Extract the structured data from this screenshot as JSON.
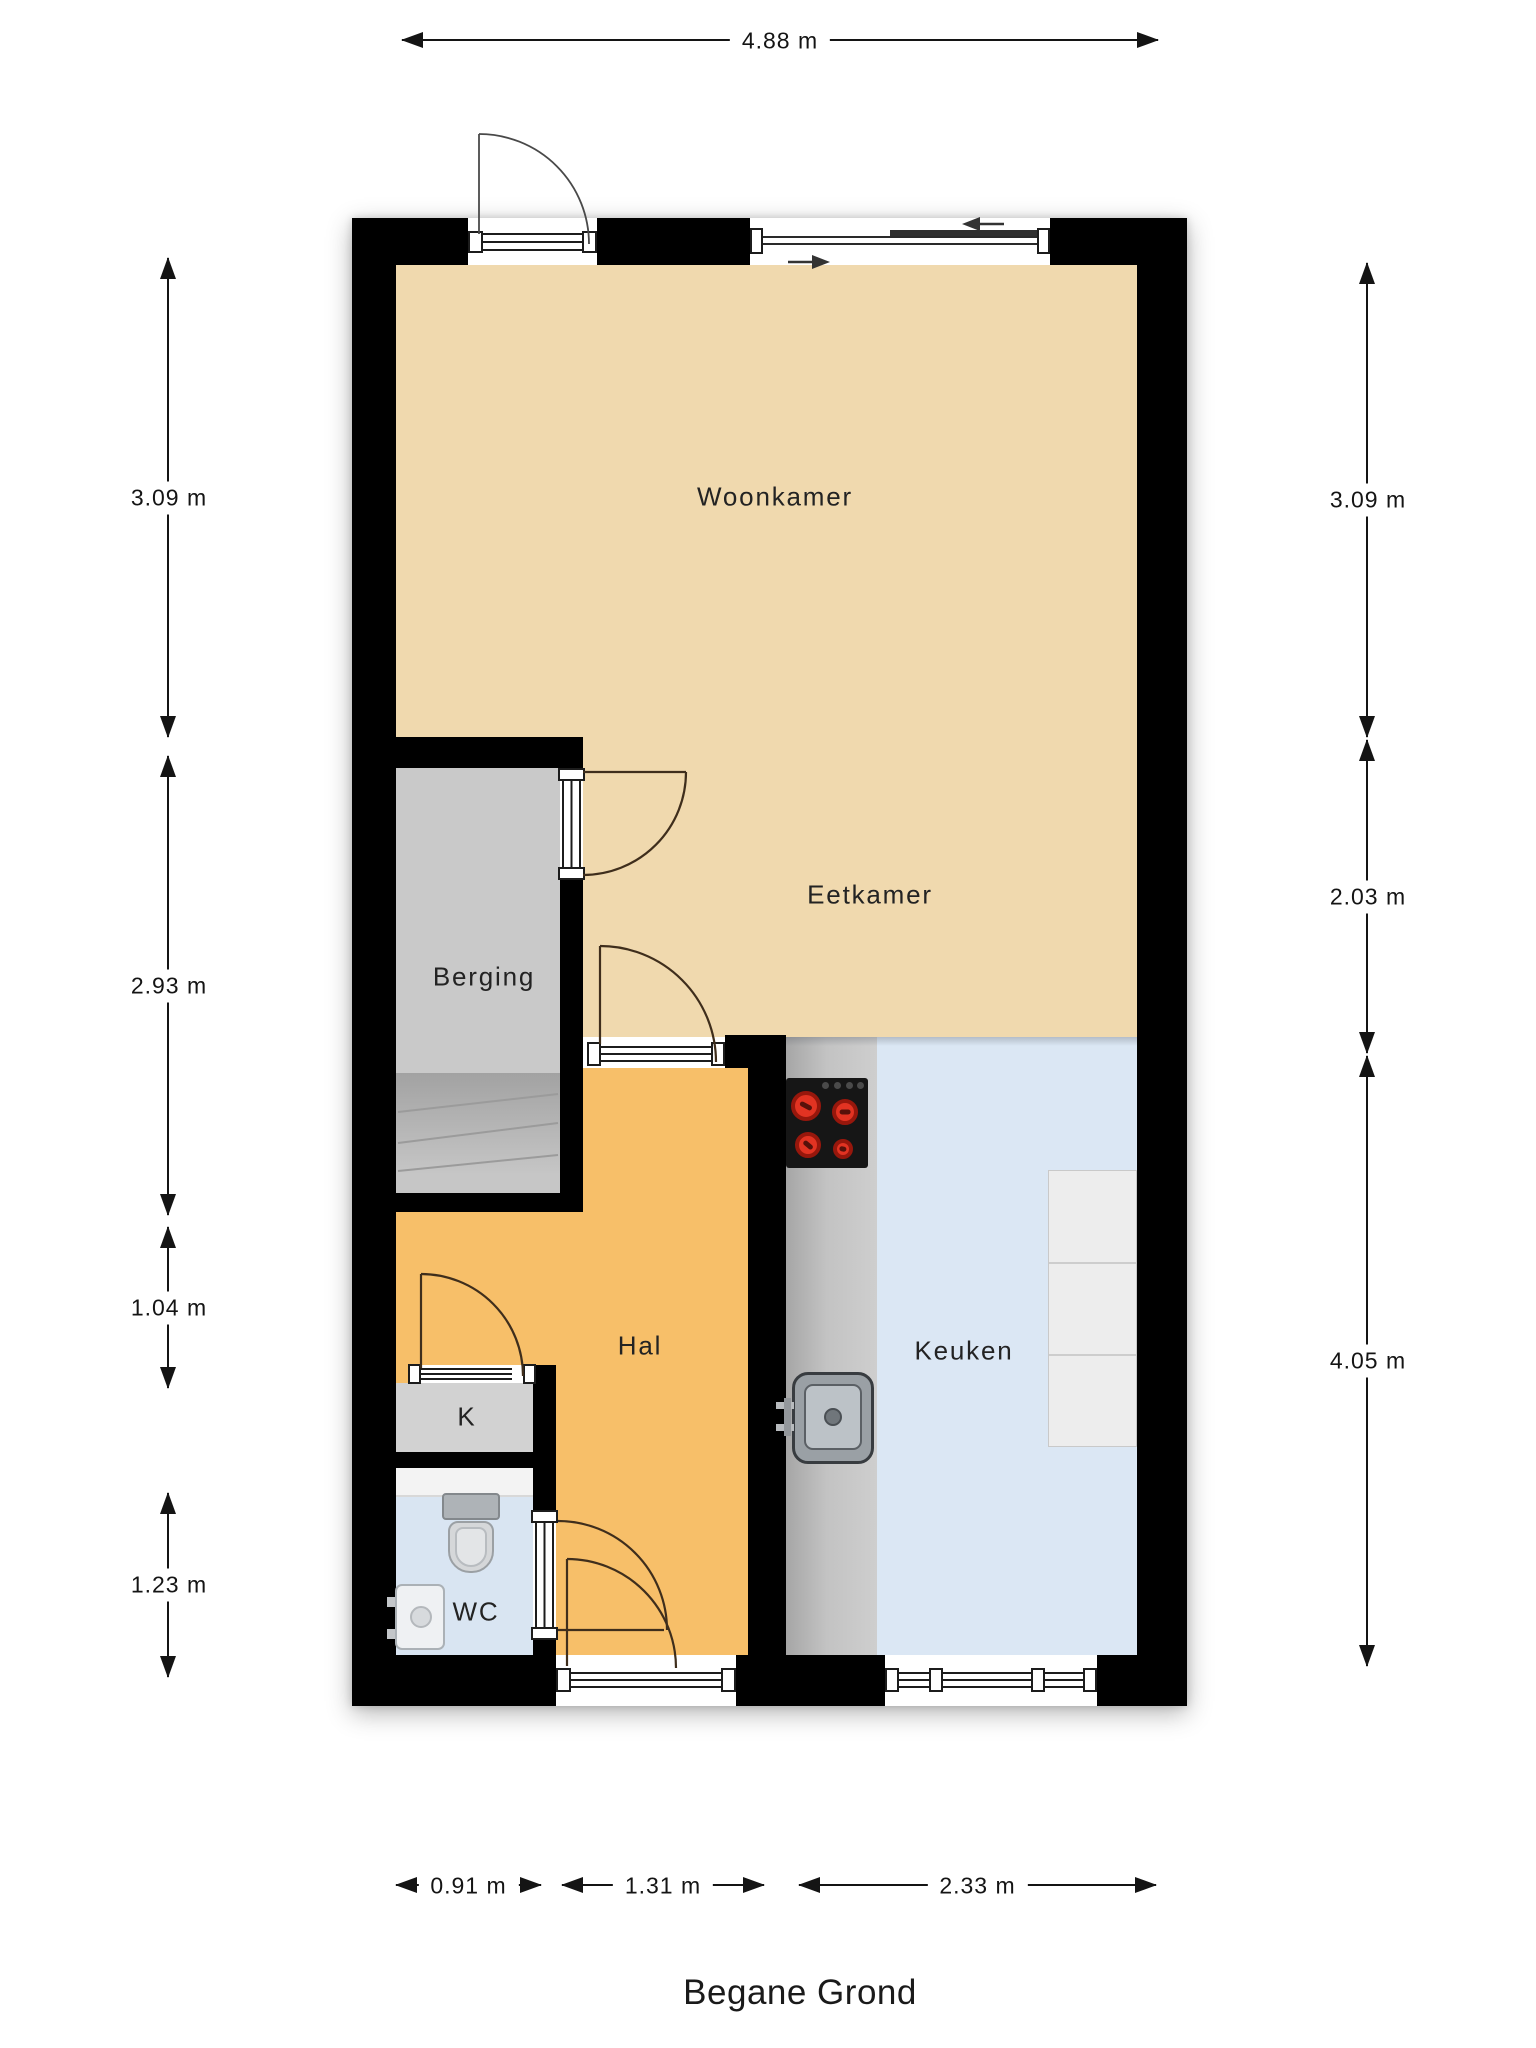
{
  "title": "Begane Grond",
  "plan": {
    "rooms": [
      {
        "id": "woonkamer",
        "label": "Woonkamer",
        "floor_color": "#f0d9ae"
      },
      {
        "id": "eetkamer",
        "label": "Eetkamer",
        "floor_color": "#f0d9ae"
      },
      {
        "id": "berging",
        "label": "Berging",
        "floor_color": "#c9c9c9"
      },
      {
        "id": "hal",
        "label": "Hal",
        "floor_color": "#f7bf69"
      },
      {
        "id": "kast",
        "label": "K",
        "floor_color": "#d2d2d2"
      },
      {
        "id": "wc",
        "label": "WC",
        "floor_color": "#d9e5f2"
      },
      {
        "id": "keuken",
        "label": "Keuken",
        "floor_color": "#dbe7f4"
      }
    ],
    "dimensions": {
      "top": [
        {
          "label": "4.88 m"
        }
      ],
      "left": [
        {
          "label": "3.09 m"
        },
        {
          "label": "2.93 m"
        },
        {
          "label": "1.04 m"
        },
        {
          "label": "1.23 m"
        }
      ],
      "right": [
        {
          "label": "3.09 m"
        },
        {
          "label": "2.03 m"
        },
        {
          "label": "4.05 m"
        }
      ],
      "bottom": [
        {
          "label": "0.91 m"
        },
        {
          "label": "1.31 m"
        },
        {
          "label": "2.33 m"
        }
      ]
    },
    "colors": {
      "wall": "#000000",
      "dimension_text": "#141414",
      "door_swing": "#3f2e1c",
      "counter": "#b5b5b5",
      "stove_burner": "#e23322"
    },
    "fixtures": [
      "stairs",
      "stove",
      "kitchen-sink",
      "refrigerator",
      "toilet",
      "hand-basin",
      "sliding-window",
      "door-swing"
    ]
  }
}
